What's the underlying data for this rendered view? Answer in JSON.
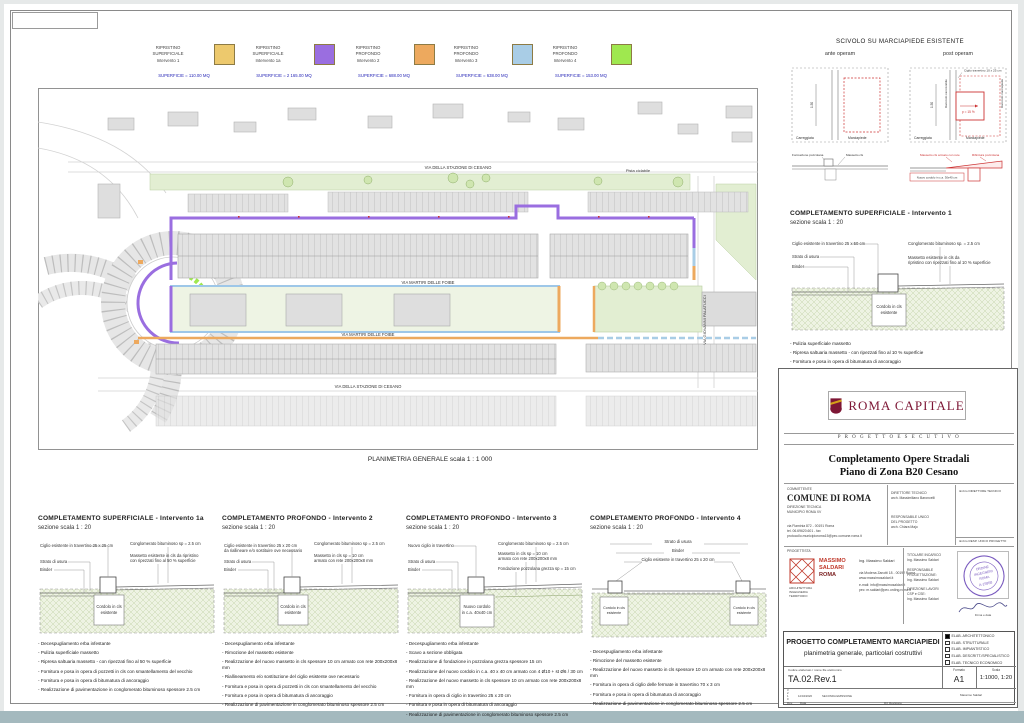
{
  "page": {
    "caption": "PLANIMETRIA GENERALE  scala 1 : 1 000"
  },
  "legend": {
    "items": [
      {
        "t1": "RIPRISTINO",
        "t2": "SUPERFICIALE",
        "t3": "Intervento 1",
        "color": "#edc96d",
        "area": "SUPERFICIE = 110.00 MQ"
      },
      {
        "t1": "RIPRISTINO",
        "t2": "SUPERFICIALE",
        "t3": "Intervento 1a",
        "color": "#9a6ee0",
        "area": "SUPERFICIE = 2 165.00 MQ"
      },
      {
        "t1": "RIPRISTINO",
        "t2": "PROFONDO",
        "t3": "Intervento 2",
        "color": "#eda95e",
        "area": "SUPERFICIE = 688.00 MQ"
      },
      {
        "t1": "RIPRISTINO",
        "t2": "PROFONDO",
        "t3": "Intervento 3",
        "color": "#a9cde6",
        "area": "SUPERFICIE = 638.00 MQ"
      },
      {
        "t1": "RIPRISTINO",
        "t2": "PROFONDO",
        "t3": "Intervento 4",
        "color": "#9fe84f",
        "area": "SUPERFICIE = 153.00 MQ"
      }
    ]
  },
  "plan": {
    "street_top": "VIA DELLA STAZIONE DI CESANO",
    "street_mid_upper": "VIA MARTIRI DELLE FOIBE",
    "street_mid_lower": "VIA MARTIRI DELLE FOIBE",
    "street_bottom": "VIA DELLA STAZIONE DI CESANO",
    "street_right": "VIA GIOVANNI PALATUCCI",
    "pista": "Pista ciclabile"
  },
  "scivolo": {
    "title": "SCIVOLO SU MARCIAPIEDE ESISTENTE",
    "ante_label": "ante operam",
    "post_label": "post operam",
    "dim": "1.50",
    "carreggiata": "Carreggiata",
    "marciapiede": "Marciapiede",
    "ciglio": "Ciglio travertino 10 x 25 cm",
    "slope": "p = 15 %",
    "raccordo_left": "Raccordo carrozzabile",
    "raccordo_right": "Raccordo marciapiede",
    "ante_sec_l1": "Formazione pozzolana",
    "ante_sec_l2": "Massetto cls",
    "post_sec_l1": "Massetto cls armato con rete",
    "post_sec_l2": "Rifinitura pozzolana",
    "post_sec_box": "Nuovo cordolo in c.a. 30x40 cm"
  },
  "sections": [
    {
      "title": "COMPLETAMENTO  SUPERFICIALE - Intervento 1a",
      "scale": "sezione scala 1 : 20",
      "l1": "Ciglio esistente in travertino 25 x 25 cm",
      "l1b": "",
      "l2": "Strato di usura",
      "l3": "Binder",
      "r1": "Conglomerato bituminoso sp = 2.5 cm",
      "r2": "Massetto esistente in cls da ripristino",
      "r2b": "con ripezzati fino al 50 % superficie",
      "c1": "Cordolo in cls",
      "c2": "esistente",
      "bullets": [
        "Decespugliamento erba infestante",
        "Pulizia superficiale massetto",
        "Ripresa saltuaria massetto - con ripezzati fino al 50 % superficie",
        "Fornitura e posa in opera di pozzetti in cls con smantellamento del vecchio",
        "Fornitura e posa in opera di bitumatura di ancoraggio",
        "Realizzazione di pavimentazione in conglomerato bituminoso spessore 2.5 cm"
      ]
    },
    {
      "title": "COMPLETAMENTO  PROFONDO - Intervento 2",
      "scale": "sezione scala 1 : 20",
      "l1": "Ciglio esistente in travertino 25 x 20 cm",
      "l1b": "da riallineare e/o sostituire ove necessario",
      "l2": "Strato di usura",
      "l3": "Binder",
      "r1": "Conglomerato bituminoso sp = 2.5 cm",
      "r2": "Massetto in cls sp = 10 cm",
      "r2b": "armato con rete 200x200x8 mm",
      "c1": "Cordolo in cls",
      "c2": "esistente",
      "bullets": [
        "Decespugliamento erba infestante",
        "Rimozione del massetto esistente",
        "Realizzazione del nuovo massetto in cls spessore 10 cm armato con rete 200x200x8 mm",
        "Riallineamento e/o sostituzione del ciglio esistente ove necessario",
        "Fornitura e posa in opera di pozzetti in cls con smantellamento del vecchio",
        "Fornitura e posa in opera di bitumatura di ancoraggio",
        "Realizzazione di pavimentazione in conglomerato bituminoso spessore 2.5 cm"
      ]
    },
    {
      "title": "COMPLETAMENTO  PROFONDO - Intervento 3",
      "scale": "sezione scala 1 : 20",
      "l1": "Nuovo ciglio in travertino",
      "l1b": "",
      "l2": "Strato di usura",
      "l3": "Binder",
      "r1": "Conglomerato bituminoso sp = 2.5 cm",
      "r2": "Massetto in cls sp = 10 cm",
      "r2b": "armato con rete 200x200x8 mm",
      "r3": "Fondazione pozzolana grezza sp = 15 cm",
      "c1": "Nuovo cordolo",
      "c2": "in c.a. 40x40 cm",
      "bullets": [
        "Decespugliamento erba infestante",
        "Scavo a sezione obbligata",
        "Realizzazione di fondazione in pozzolana grezza spessore 15 cm",
        "Realizzazione del nuovo cordolo in c.a. 40 x 40 cm armato con 4 Ø10 + st Ø6 / 30 cm",
        "Realizzazione del nuovo massetto in cls spessore 10 cm armato con rete 200x200x8 mm",
        "Fornitura in opera di ciglio in travertino 25 x 20 cm",
        "Fornitura e posa in opera di bitumatura di ancoraggio",
        "Realizzazione di pavimentazione in conglomerato bituminoso spessore 2.5 cm"
      ]
    },
    {
      "title": "COMPLETAMENTO  PROFONDO - Intervento 4",
      "scale": "sezione scala 1 : 20",
      "l1": "Strato di usura",
      "l2": "Binder",
      "l3": "Ciglio esistente in travertino 25 x 20 cm",
      "c1": "Cordolo in cls",
      "c2": "esistente",
      "bullets": [
        "Decespugliamento erba infestante",
        "Rimozione del massetto esistente",
        "Realizzazione del nuovo massetto in cls spessore 10 cm armato con rete 200x200x8 mm",
        "Fornitura in opera di ciglio delle fermate in travertino 70 x 3 cm",
        "Fornitura e posa in opera di bitumatura di ancoraggio",
        "Realizzazione di pavimentazione in conglomerato bituminoso spessore 2.5 cm"
      ]
    },
    {
      "title": "COMPLETAMENTO  SUPERFICIALE - Intervento 1",
      "scale": "sezione scala 1 : 20",
      "l1": "Ciglio esistente in travertino 25 x 50 cm",
      "l1b": "",
      "l2": "Strato di usura",
      "l3": "Binder",
      "r1": "Conglomerato bituminoso sp. = 2.5 cm",
      "r2": "Massetto esistente in cls da",
      "r2b": "ripristino con ripezzati fino al 10 % superficie",
      "c1": "Cordolo in cls",
      "c2": "esistente",
      "bullets": [
        "Pulizia superficiale massetto",
        "Ripresa saltuaria massetto - con ripezzati fino al 10 % superficie",
        "Fornitura e posa in opera di bitumatura di ancoraggio",
        "Realizzazione di pavimentazione in conglomerato bituminoso spessore 2.5 cm"
      ]
    }
  ],
  "titleblock": {
    "roma_capitale": "ROMA CAPITALE",
    "progetto_esecutivo": "P R O G E T T O   E S E C U T I V O",
    "title1": "Completamento Opere Stradali",
    "title2": "Piano di Zona B20 Cesano",
    "committente_label": "COMMITTENTE",
    "committente_name": "COMUNE DI ROMA",
    "committente_line1": "DIREZIONE TECNICA",
    "committente_line2": "MUNICIPIO ROMA XV",
    "committente_addr1": "via Flaminia 872 - 00191 Roma",
    "committente_addr2": "tel. 06.69620.601 - fax",
    "committente_addr3": "protocollo.municipioroma15@pec.comune.roma.it",
    "dt_label": "DIRETTORE TECNICO",
    "dt_name": "arch. Massimiliano Baroncelli",
    "rup_label": "RESPONSABILE UNICO",
    "rup_label2": "DEL PROGETTO",
    "rup_name": "arch. Chiara Majo",
    "timbro_dt": "timbro DIRETTORE TECNICO",
    "timbro_rup": "timbro RESP. UNICO PROGETTO",
    "progettista_label": "PROGETTISTA",
    "logo_line1": "MASSIMO",
    "logo_line2": "SALDARI",
    "logo_line3": "ROMA",
    "logo_side1": "ARCHITETTURA",
    "logo_side2": "INGEGNERIA",
    "logo_side3": "TERRITORIO",
    "prog_name": "Ing. Massimo Saldari",
    "prog_addr": "via Modena Zanotti 18 - 00192 Roma",
    "prog_web": "www.massimosaldari.it",
    "prog_mail": "e-mail:  info@massimosaldari.it",
    "prog_pec": "pec:  m.saldari@pec.ording.roma.it",
    "role1_label": "TITOLARE INCARICO",
    "role1_name": "Ing. Massimo Saldari",
    "role2_label": "RESPONSABILE",
    "role2_label2": "PROGETTAZIONE:",
    "role2_name": "Ing. Massimo Saldari",
    "role3_label": "DIREZIONE LAVORI",
    "role3_label2": "CSP e CSE:",
    "role3_name": "Ing. Massimo Saldari",
    "stamp_l1": "ORDINE",
    "stamp_l2": "INGEGNERI",
    "stamp_l3": "ROMA",
    "stamp_l4": "A-15958",
    "firma": "Firma e data",
    "project_title": "PROGETTO COMPLETAMENTO MARCIAPIEDI",
    "project_subtitle": "planimetria generale, particolari costruttivi",
    "elab": [
      "ELAB. ARCHITETTONICO",
      "ELAB. STRUTTURALE",
      "ELAB. IMPIANTISTICO",
      "ELAB. DESCRITT./SPECIALISTICO",
      "ELAB. TECNICO ECONOMICO"
    ],
    "codice_label": "Codice elaborato / nome file elettronico",
    "codice": "TA.02.Rev.1",
    "formato_label": "Formato",
    "formato": "A1",
    "scala_label": "Scala",
    "scala": "1:1000, 1:20",
    "rev_rows": [
      "3",
      "2",
      "1",
      "0"
    ],
    "rev1_date": "12/04/2020",
    "rev1_desc": "SECONDA EMISSIONE",
    "rev_label": "Rev.",
    "data_label": "Data",
    "rif_label": "Rif. Revisione",
    "firmatario": "Massimo Saldari"
  }
}
